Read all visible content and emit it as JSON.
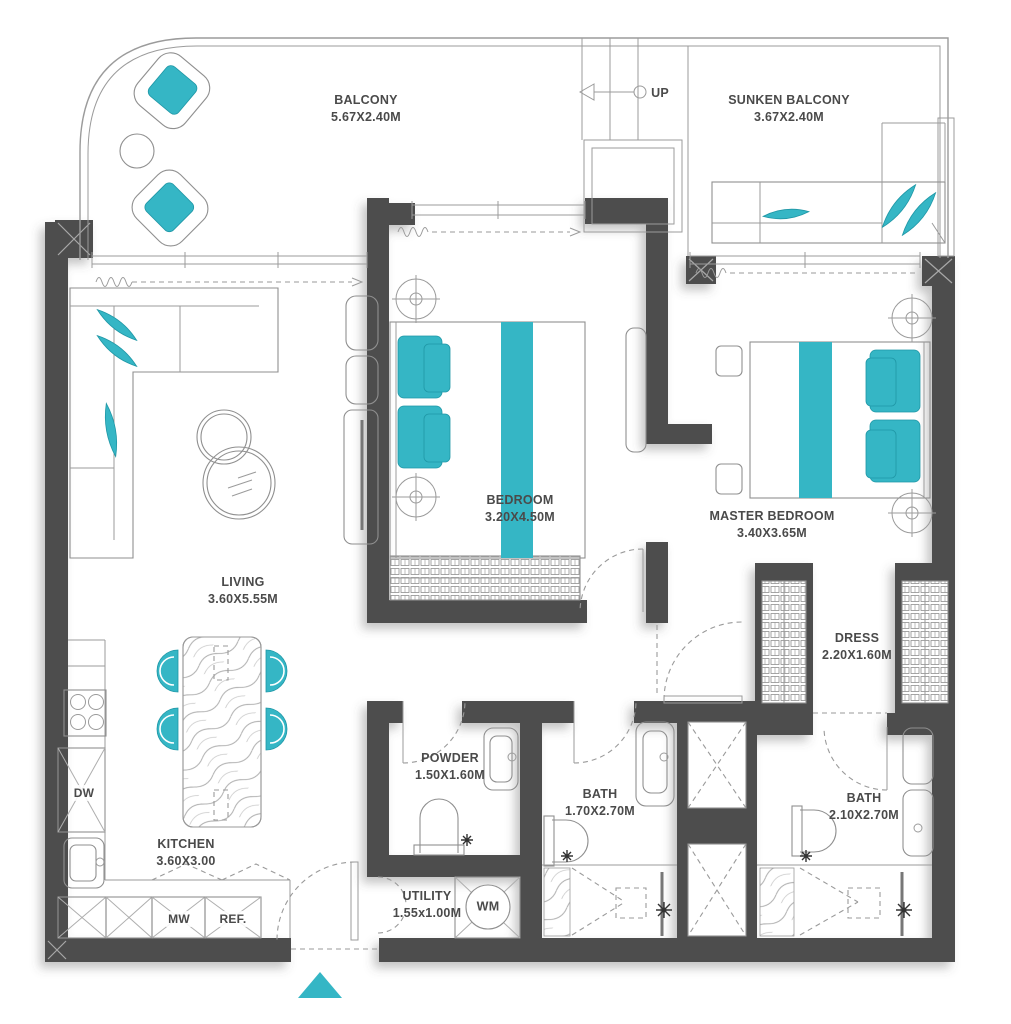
{
  "plan": {
    "colors": {
      "accent": "#35b6c5",
      "wall": "#4e4e4e",
      "line": "#9b9b9b",
      "label": "#4a4a4a"
    },
    "rooms": {
      "balcony": {
        "name": "BALCONY",
        "dims": "5.67X2.40M"
      },
      "sunken_balcony": {
        "name": "SUNKEN BALCONY",
        "dims": "3.67X2.40M"
      },
      "bedroom": {
        "name": "BEDROOM",
        "dims": "3.20X4.50M"
      },
      "master_bedroom": {
        "name": "MASTER BEDROOM",
        "dims": "3.40X3.65M"
      },
      "living": {
        "name": "LIVING",
        "dims": "3.60X5.55M"
      },
      "dress": {
        "name": "DRESS",
        "dims": "2.20X1.60M"
      },
      "powder": {
        "name": "POWDER",
        "dims": "1.50X1.60M"
      },
      "bath1": {
        "name": "BATH",
        "dims": "1.70X2.70M"
      },
      "bath2": {
        "name": "BATH",
        "dims": "2.10X2.70M"
      },
      "kitchen": {
        "name": "KITCHEN",
        "dims": "3.60X3.00"
      },
      "utility": {
        "name": "UTILITY",
        "dims": "1.55x1.00M"
      }
    },
    "markers": {
      "up": "UP",
      "wm": "WM",
      "dw": "DW",
      "mw": "MW",
      "ref": "REF."
    }
  }
}
